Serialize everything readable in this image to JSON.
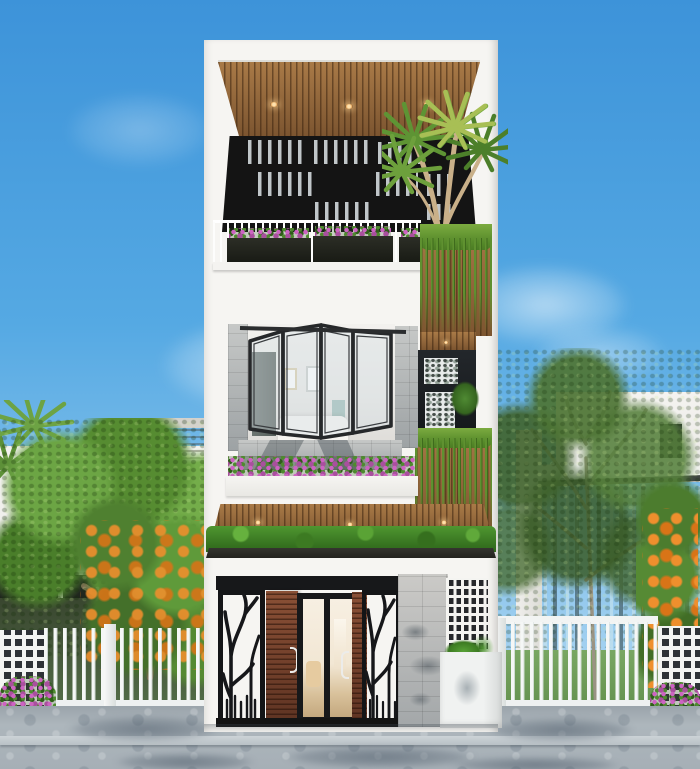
{
  "scene": {
    "description": "Daytime 3D exterior render of a modern three-storey white townhouse with wood-slat accents, rooftop pergola terrace, folding glass windows, green vine walls, decorative branch-pattern entrance gates, flanked by trees, white fences and neighboring houses under a clear blue sky.",
    "objects": [
      "blue sky with wispy clouds",
      "rooftop pergola with wooden slat ceiling and three recessed downlights",
      "black louvered pergola openings",
      "rooftop palm tree",
      "white balcony railing with three flower planters",
      "wood panel with hanging green vines",
      "black-framed folding glass window with bedroom interior",
      "window flower planter over grey tile band",
      "wooden canopy with three downlights above green hedge band",
      "entrance with branch-pattern black gates, wooden doors and glass door",
      "grey stone feature wall and white breeze-block screen",
      "white planter box with green plants",
      "white picket fences and lattice pillars",
      "left neighbor house with striped stone block",
      "right neighbor house with glass facade",
      "green trees and orange fruit trees",
      "grey paved sidewalk with tree shadows"
    ],
    "counts": {
      "roof_downlights": 3,
      "canopy_downlights": 3,
      "balcony_planters": 3,
      "folding_window_panels": 4,
      "gate_panels": 2
    }
  },
  "palette": {
    "sky_top": "#3d93d9",
    "sky_mid": "#55a9e3",
    "sky_low": "#8ac4ec",
    "sky_horizon": "#bfdff5",
    "facade": "#f6f5f2",
    "facade_shade": "#e4e3df",
    "wood": "#9a6a3e",
    "wood_dark": "#4a3018",
    "pergola_dark": "#141414",
    "louver": "#d7dee2",
    "vine_green": "#5f9130",
    "hedge_green": "#2f6a1c",
    "flower": "#cd63c2",
    "frame_black": "#202224",
    "glass_tint": "#dde6ea",
    "door_wood": "#7a4630",
    "gate_black": "#17181a",
    "breeze_hole": "#26282b",
    "tile_gray": "#aeb2b3",
    "stone_gray": "#b4b3ae",
    "fence_white": "#f5f7f6",
    "lawn_green": "#6f9e58",
    "leaf_green": "#5d9038",
    "leaf_dark": "#3c6423",
    "trunk_brown": "#7b6a52",
    "trunk_pale": "#9a9383",
    "orange": "#ef8f2d",
    "paving_gray": "#a7b0b6",
    "paving_shadow": "#5e6f80",
    "curb_light": "#ccd3d7",
    "neighbor_wall": "#f1f0ed",
    "neighbor_stone": "#b0ada6",
    "neighbor_glass": "#45544a",
    "interior_warm": "#f5ecdf"
  }
}
